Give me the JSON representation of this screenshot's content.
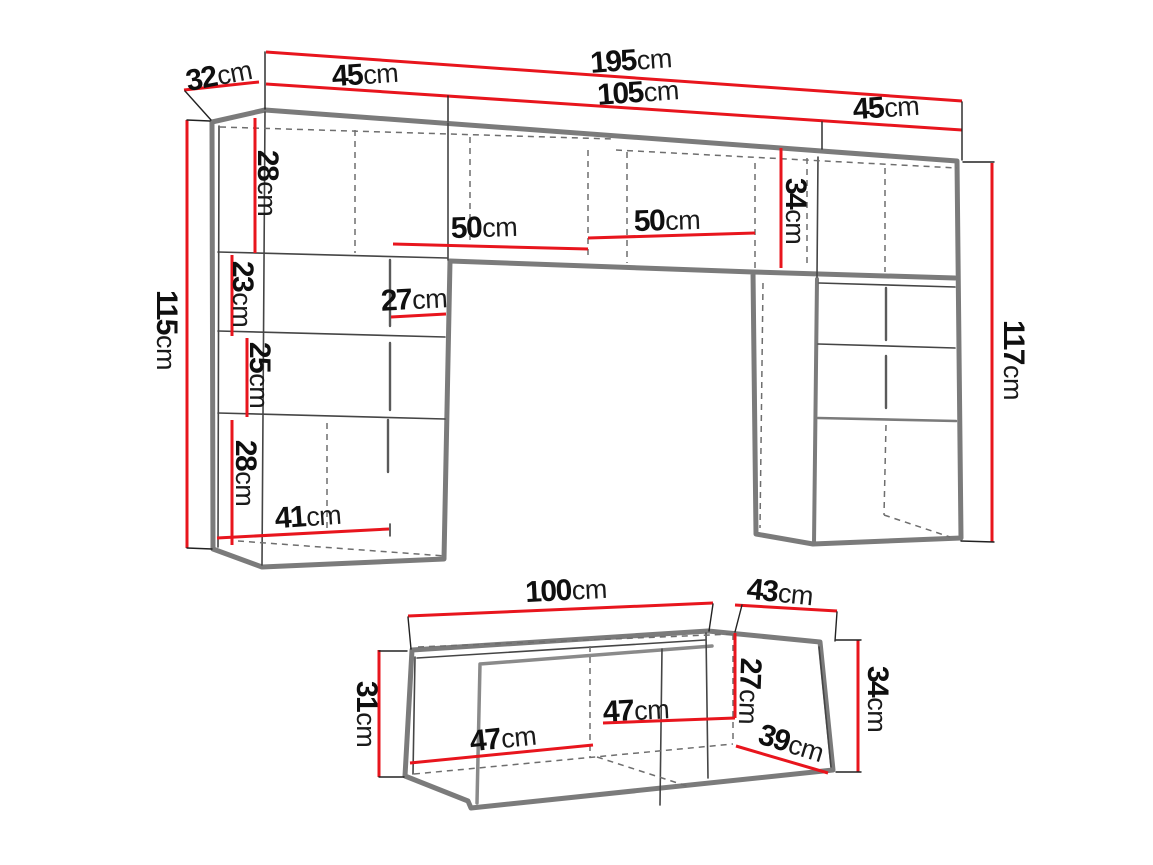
{
  "figure": {
    "type": "furniture-dimension-diagram",
    "parts": [
      "wall-unit",
      "tv-stand"
    ]
  },
  "colors": {
    "dimension_line_red": "#e8151d",
    "outline_gray": "#7b7b7b",
    "thin_line": "#454545",
    "dashed_line": "#6e6e6e",
    "tick_black": "#222222",
    "background": "#ffffff",
    "text": "#0f0f0f"
  },
  "wall_unit": {
    "depth": {
      "v": "32",
      "u": "cm"
    },
    "total_width": {
      "v": "195",
      "u": "cm"
    },
    "left_section_width": {
      "v": "45",
      "u": "cm"
    },
    "middle_section_width": {
      "v": "105",
      "u": "cm"
    },
    "right_section_width": {
      "v": "45",
      "u": "cm"
    },
    "left_column_height": {
      "v": "115",
      "u": "cm"
    },
    "right_column_height": {
      "v": "117",
      "u": "cm"
    },
    "top_row_height": {
      "v": "34",
      "u": "cm"
    },
    "left_cell1_height": {
      "v": "28",
      "u": "cm"
    },
    "left_cell2_height": {
      "v": "23",
      "u": "cm"
    },
    "left_cell3_height": {
      "v": "25",
      "u": "cm"
    },
    "left_cell4_height": {
      "v": "28",
      "u": "cm"
    },
    "left_cell_width": {
      "v": "27",
      "u": "cm"
    },
    "left_bottom_width": {
      "v": "41",
      "u": "cm"
    },
    "middle_shelf_left_width": {
      "v": "50",
      "u": "cm"
    },
    "middle_shelf_right_width": {
      "v": "50",
      "u": "cm"
    }
  },
  "tv_stand": {
    "width": {
      "v": "100",
      "u": "cm"
    },
    "depth": {
      "v": "43",
      "u": "cm"
    },
    "left_height": {
      "v": "31",
      "u": "cm"
    },
    "inner_left_width": {
      "v": "47",
      "u": "cm"
    },
    "inner_right_width": {
      "v": "47",
      "u": "cm"
    },
    "inner_height": {
      "v": "27",
      "u": "cm"
    },
    "bottom_depth": {
      "v": "39",
      "u": "cm"
    },
    "right_height": {
      "v": "34",
      "u": "cm"
    }
  }
}
